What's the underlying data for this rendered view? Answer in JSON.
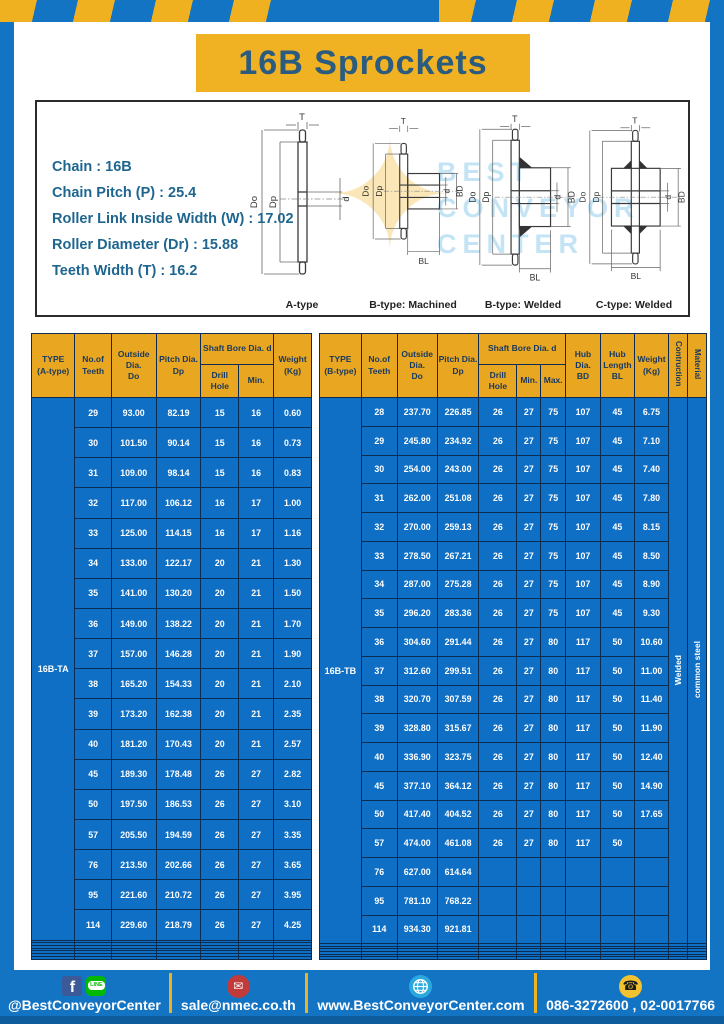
{
  "title": "16B Sprockets",
  "specs": {
    "lines": [
      "Chain  :  16B",
      "Chain Pitch (P)  :  25.4",
      "Roller Link Inside Width (W)  :  17.02",
      "Roller Diameter (Dr) : 15.88",
      "Teeth Width (T)  :  16.2"
    ]
  },
  "watermark": {
    "line1": "BEST",
    "line2": "CONVEYOR",
    "line3": "CENTER",
    "star": "✦"
  },
  "drawings": {
    "dims": {
      "t": "T",
      "do": "Do",
      "dp": "Dp",
      "d": "d",
      "bd": "BD",
      "bl": "BL"
    },
    "items": [
      {
        "label": "A-type"
      },
      {
        "label": "B-type: Machined"
      },
      {
        "label": "B-type: Welded"
      },
      {
        "label": "C-type: Welded"
      }
    ]
  },
  "table_a": {
    "col_type": "TYPE\n(A-type)",
    "col_teeth": "No.of\nTeeth",
    "col_do": "Outside\nDia.\nDo",
    "col_dp": "Pitch Dia.\nDp",
    "col_bore": "Shaft Bore Dia. d",
    "col_drill": "Drill Hole",
    "col_min": "Min.",
    "col_weight": "Weight\n(Kg)",
    "type_value": "16B-TA",
    "empty_rows": 7,
    "rows": [
      [
        "29",
        "93.00",
        "82.19",
        "15",
        "16",
        "0.60"
      ],
      [
        "30",
        "101.50",
        "90.14",
        "15",
        "16",
        "0.73"
      ],
      [
        "31",
        "109.00",
        "98.14",
        "15",
        "16",
        "0.83"
      ],
      [
        "32",
        "117.00",
        "106.12",
        "16",
        "17",
        "1.00"
      ],
      [
        "33",
        "125.00",
        "114.15",
        "16",
        "17",
        "1.16"
      ],
      [
        "34",
        "133.00",
        "122.17",
        "20",
        "21",
        "1.30"
      ],
      [
        "35",
        "141.00",
        "130.20",
        "20",
        "21",
        "1.50"
      ],
      [
        "36",
        "149.00",
        "138.22",
        "20",
        "21",
        "1.70"
      ],
      [
        "37",
        "157.00",
        "146.28",
        "20",
        "21",
        "1.90"
      ],
      [
        "38",
        "165.20",
        "154.33",
        "20",
        "21",
        "2.10"
      ],
      [
        "39",
        "173.20",
        "162.38",
        "20",
        "21",
        "2.35"
      ],
      [
        "40",
        "181.20",
        "170.43",
        "20",
        "21",
        "2.57"
      ],
      [
        "45",
        "189.30",
        "178.48",
        "26",
        "27",
        "2.82"
      ],
      [
        "50",
        "197.50",
        "186.53",
        "26",
        "27",
        "3.10"
      ],
      [
        "57",
        "205.50",
        "194.59",
        "26",
        "27",
        "3.35"
      ],
      [
        "76",
        "213.50",
        "202.66",
        "26",
        "27",
        "3.65"
      ],
      [
        "95",
        "221.60",
        "210.72",
        "26",
        "27",
        "3.95"
      ],
      [
        "114",
        "229.60",
        "218.79",
        "26",
        "27",
        "4.25"
      ]
    ]
  },
  "table_b": {
    "col_type": "TYPE\n(B-type)",
    "col_teeth": "No.of\nTeeth",
    "col_do": "Outside\nDia.\nDo",
    "col_dp": "Pitch Dia.\nDp",
    "col_bore": "Shaft Bore Dia. d",
    "col_drill": "Drill Hole",
    "col_min": "Min.",
    "col_max": "Max.",
    "col_bd": "Hub Dia.\nBD",
    "col_bl": "Hub\nLength\nBL",
    "col_weight": "Weight\n(Kg)",
    "col_construction": "Contruction",
    "col_material": "Material",
    "type_value": "16B-TB",
    "construction": "Welded",
    "material": "common steel",
    "empty_rows": 6,
    "rows": [
      [
        "28",
        "237.70",
        "226.85",
        "26",
        "27",
        "75",
        "107",
        "45",
        "6.75"
      ],
      [
        "29",
        "245.80",
        "234.92",
        "26",
        "27",
        "75",
        "107",
        "45",
        "7.10"
      ],
      [
        "30",
        "254.00",
        "243.00",
        "26",
        "27",
        "75",
        "107",
        "45",
        "7.40"
      ],
      [
        "31",
        "262.00",
        "251.08",
        "26",
        "27",
        "75",
        "107",
        "45",
        "7.80"
      ],
      [
        "32",
        "270.00",
        "259.13",
        "26",
        "27",
        "75",
        "107",
        "45",
        "8.15"
      ],
      [
        "33",
        "278.50",
        "267.21",
        "26",
        "27",
        "75",
        "107",
        "45",
        "8.50"
      ],
      [
        "34",
        "287.00",
        "275.28",
        "26",
        "27",
        "75",
        "107",
        "45",
        "8.90"
      ],
      [
        "35",
        "296.20",
        "283.36",
        "26",
        "27",
        "75",
        "107",
        "45",
        "9.30"
      ],
      [
        "36",
        "304.60",
        "291.44",
        "26",
        "27",
        "80",
        "117",
        "50",
        "10.60"
      ],
      [
        "37",
        "312.60",
        "299.51",
        "26",
        "27",
        "80",
        "117",
        "50",
        "11.00"
      ],
      [
        "38",
        "320.70",
        "307.59",
        "26",
        "27",
        "80",
        "117",
        "50",
        "11.40"
      ],
      [
        "39",
        "328.80",
        "315.67",
        "26",
        "27",
        "80",
        "117",
        "50",
        "11.90"
      ],
      [
        "40",
        "336.90",
        "323.75",
        "26",
        "27",
        "80",
        "117",
        "50",
        "12.40"
      ],
      [
        "45",
        "377.10",
        "364.12",
        "26",
        "27",
        "80",
        "117",
        "50",
        "14.90"
      ],
      [
        "50",
        "417.40",
        "404.52",
        "26",
        "27",
        "80",
        "117",
        "50",
        "17.65"
      ],
      [
        "57",
        "474.00",
        "461.08",
        "26",
        "27",
        "80",
        "117",
        "50",
        ""
      ],
      [
        "76",
        "627.00",
        "614.64",
        "",
        "",
        "",
        "",
        "",
        ""
      ],
      [
        "95",
        "781.10",
        "768.22",
        "",
        "",
        "",
        "",
        "",
        ""
      ],
      [
        "114",
        "934.30",
        "921.81",
        "",
        "",
        "",
        "",
        "",
        ""
      ]
    ]
  },
  "footer": {
    "facebook_letter": "f",
    "line_text": "LINE",
    "social_label": "@BestConveyorCenter",
    "email_glyph": "✉",
    "email": "sale@nmec.co.th",
    "website": "www.BestConveyorCenter.com",
    "phone_glyph": "☎",
    "phone": "086-3272600 , 02-0017766"
  },
  "colors": {
    "frame_blue": "#1474C4",
    "cell_blue": "#0F6FC4",
    "border_navy": "#0C2C52",
    "header_yellow": "#E9A621",
    "title_yellow": "#F0B222",
    "stripe_yellow": "#EFB11F",
    "title_text": "#2B5B7E",
    "spec_text": "#1E6690",
    "bottom_edge_blue": "#0E5C9C"
  }
}
